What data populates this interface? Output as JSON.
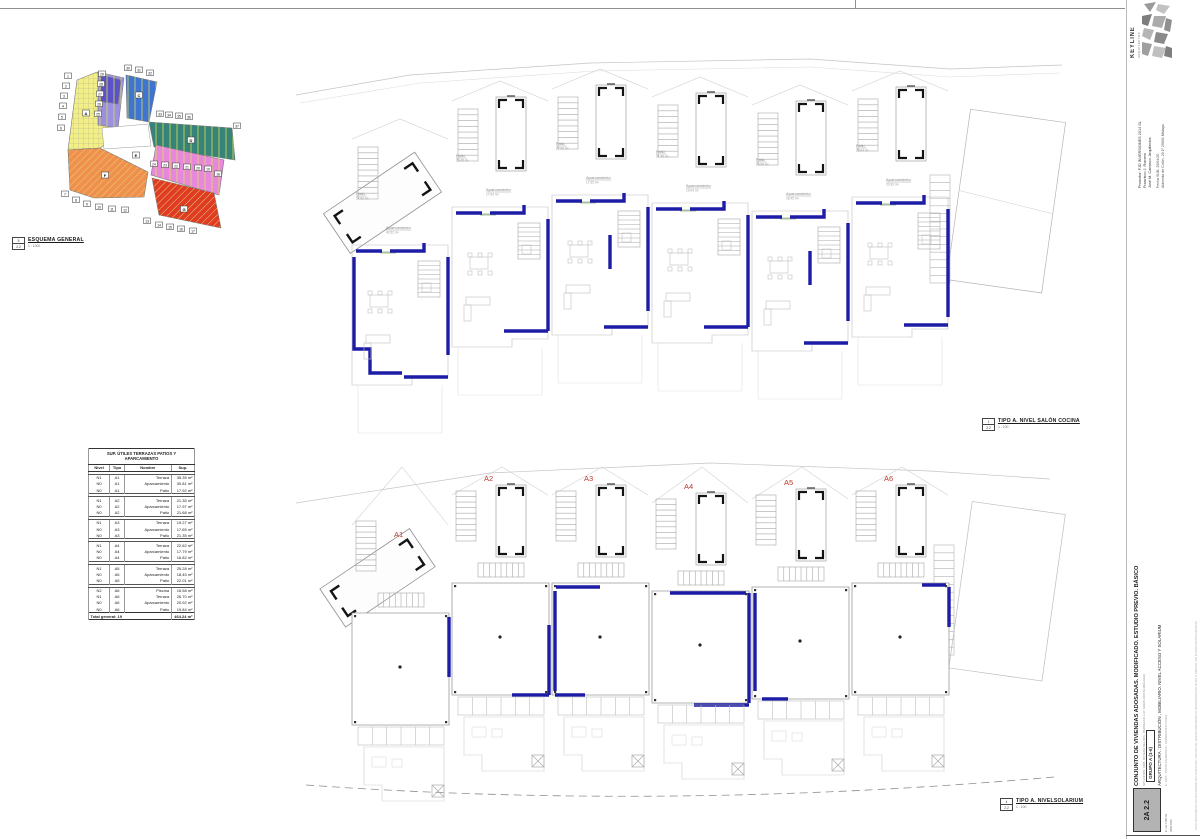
{
  "logo": {
    "brand": "KEYLINE",
    "sub": "ARQUITECTOS"
  },
  "titleblock": {
    "promotor1": "Promotor: FJD INVERSIONES 2014 SL",
    "promotor2": "Francisco J. Romero",
    "promotor3": "José M. Carrasco. Arquitectos",
    "contact1": "Fecha SUB: 29/04/20",
    "contact2": "Alameda de Colón, 29 1º 29001 Málaga"
  },
  "right_title": {
    "main": "CONJUNTO DE VIVIENDAS ADOSADAS. MODIFICADO. ESTUDIO PREVIO. BÁSICO",
    "sub": "SITUACIÓN: URB. RIVIERA DEL SOL. PARCELAS 1-37. MIJAS COSTA (MÁLAGA)",
    "group": "GRUPO A (1-6)",
    "discipline": "ARQUITECTURA : DISTRIBUCIÓN , MOBILIARIO. NIVEL ACCESO Y SOLARIUM",
    "note": "E: 1/100 . COTAS EN METROS . SUPERFICIES ÚTILES",
    "legal": "ESTE DOCUMENTO ES PROPIEDAD DEL AUTOR DEL PROYECTO. QUEDA PROHIBIDA SU REPRODUCCIÓN TOTAL O PARCIAL SIN AUTORIZACIÓN EXPRESA",
    "sheet_no": "2A 2.2",
    "sheet_note1": "E: var / DIN A1",
    "sheet_note2": "ABR 2020"
  },
  "esquema": {
    "label": "ESQUEMA GENERAL",
    "scale": "1 : 1000",
    "ref_top": "5",
    "ref_bottom": "2.2"
  },
  "plan1": {
    "label": "TIPO A. NIVEL SALÓN COCINA",
    "scale": "1 : 100",
    "ref_top": "1",
    "ref_bottom": "2.2"
  },
  "plan2": {
    "label": "TIPO A. NIVELSOLARIUM",
    "scale": "1 : 100",
    "ref_top": "4",
    "ref_bottom": "2.2"
  },
  "colors": {
    "wall_blue": "#1c1ca6",
    "unit_red": "#c0392b",
    "line_gray": "#9a9a9a",
    "line_light": "#c4c4c4",
    "line_faint": "#d9d9d9",
    "bracket_black": "#141414"
  },
  "plan1_units": [
    {
      "id": "A1",
      "patio_label": "Patio",
      "patio_area": "17.92 m²",
      "aparc_label": "Aparcamiento",
      "aparc_area": "40.52 m²"
    },
    {
      "id": "A2",
      "patio_label": "Patio",
      "patio_area": "23.45 m²",
      "aparc_label": "Aparcamiento",
      "aparc_area": "17.54 m²"
    },
    {
      "id": "A3",
      "patio_label": "Patio",
      "patio_area": "27.05 m²",
      "aparc_label": "Aparcamiento",
      "aparc_area": "17.65 m²"
    },
    {
      "id": "A4",
      "patio_label": "Patio",
      "patio_area": "21.35 m²",
      "aparc_label": "Aparcamiento",
      "aparc_area": "19.94 m²"
    },
    {
      "id": "A5",
      "patio_label": "Patio",
      "patio_area": "20.09 m²",
      "aparc_label": "Aparcamiento",
      "aparc_area": "18.45 m²"
    },
    {
      "id": "A6",
      "patio_label": "Patio",
      "patio_area": "23.04 m²",
      "aparc_label": "Aparcamiento",
      "aparc_area": "20.92 m²"
    }
  ],
  "plan2_units": [
    {
      "id": "A1"
    },
    {
      "id": "A2"
    },
    {
      "id": "A3"
    },
    {
      "id": "A4"
    },
    {
      "id": "A5"
    },
    {
      "id": "A6"
    }
  ],
  "table": {
    "title": "SUP. ÚTILES TERRAZAS PATIOS Y APARCAMIENTO",
    "headers": [
      "Nivel",
      "Tipo",
      "Nombre",
      "Sup."
    ],
    "groups": [
      {
        "rows": [
          [
            "N1",
            "A1",
            "Terraza",
            "35.35 m²"
          ],
          [
            "N0",
            "A1",
            "Aparcamiento",
            "30.81 m²"
          ],
          [
            "N0",
            "A1",
            "Patio",
            "17.92 m²"
          ]
        ]
      },
      {
        "rows": [
          [
            "N1",
            "A2",
            "Terraza",
            "21.35 m²"
          ],
          [
            "N0",
            "A2",
            "Aparcamiento",
            "17.97 m²"
          ],
          [
            "N0",
            "A2",
            "Patio",
            "21.68 m²"
          ]
        ]
      },
      {
        "rows": [
          [
            "N1",
            "A3",
            "Terraza",
            "19.27 m²"
          ],
          [
            "N0",
            "A3",
            "Aparcamiento",
            "17.65 m²"
          ],
          [
            "N0",
            "A3",
            "Patio",
            "21.35 m²"
          ]
        ]
      },
      {
        "rows": [
          [
            "N1",
            "A4",
            "Terraza",
            "22.62 m²"
          ],
          [
            "N0",
            "A4",
            "Aparcamiento",
            "17.79 m²"
          ],
          [
            "N0",
            "A4",
            "Patio",
            "16.82 m²"
          ]
        ]
      },
      {
        "rows": [
          [
            "N1",
            "A5",
            "Terraza",
            "25.28 m²"
          ],
          [
            "N0",
            "A5",
            "Aparcamiento",
            "18.45 m²"
          ],
          [
            "N0",
            "A5",
            "Patio",
            "22.01 m²"
          ]
        ]
      },
      {
        "rows": [
          [
            "N2",
            "A6",
            "Piscina",
            "16.58 m²"
          ],
          [
            "N1",
            "A6",
            "Terraza",
            "26.70 m²"
          ],
          [
            "N0",
            "A6",
            "Aparcamiento",
            "20.92 m²"
          ],
          [
            "N0",
            "A6",
            "Patio",
            "19.84 m²"
          ]
        ]
      }
    ],
    "total_label": "Total general: 19",
    "total_value": "464.24 m²"
  },
  "siteplan": {
    "zones": [
      {
        "name": "zona-amarilla",
        "color": "#f2ef86",
        "letter": "A",
        "lx": 78,
        "ly": 86,
        "points": "69,52 89,44 94,52 101,114 92,120 60,122",
        "hatch": "grid"
      },
      {
        "name": "zona-violeta",
        "color": "#9a8fe0",
        "letter": "B",
        "lx": 100,
        "ly": 72,
        "points": "90,44 116,50 110,100 90,97",
        "hatch": "vert"
      },
      {
        "name": "zona-violeta-int",
        "color": "#5b52c7",
        "letter": "",
        "lx": 0,
        "ly": 0,
        "points": "93,47 113,52 110,76 93,73",
        "hatch": "vert"
      },
      {
        "name": "zona-azul",
        "color": "#3f74d2",
        "letter": "C",
        "lx": 131,
        "ly": 68,
        "points": "118,47 149,54 141,94 119,90",
        "hatch": "vert"
      },
      {
        "name": "zona-verde",
        "color": "#37837a",
        "letter": "D",
        "lx": 183,
        "ly": 113,
        "points": "141,94 224,100 227,132 146,119",
        "hatch": "vert"
      },
      {
        "name": "zona-rosa",
        "color": "#e888dd",
        "letter": "E",
        "lx": 128,
        "ly": 128,
        "points": "148,117 216,132 211,167 143,147",
        "hatch": "vert"
      },
      {
        "name": "zona-naranja",
        "color": "#ef9052",
        "letter": "F",
        "lx": 97,
        "ly": 148,
        "points": "60,122 92,120 140,144 136,169 86,170 62,162",
        "hatch": "diag"
      },
      {
        "name": "zona-roja",
        "color": "#e03a28",
        "letter": "G",
        "lx": 176,
        "ly": 182,
        "points": "144,150 206,165 213,200 151,187",
        "hatch": "diag"
      }
    ],
    "court_points": "94,100 140,96 143,118 96,121",
    "numbers": [
      {
        "n": "1",
        "x": 60,
        "y": 48
      },
      {
        "n": "2",
        "x": 58,
        "y": 58
      },
      {
        "n": "3",
        "x": 56,
        "y": 68
      },
      {
        "n": "4",
        "x": 55,
        "y": 78
      },
      {
        "n": "5",
        "x": 54,
        "y": 89
      },
      {
        "n": "6",
        "x": 53,
        "y": 100
      },
      {
        "n": "7",
        "x": 57,
        "y": 166
      },
      {
        "n": "8",
        "x": 68,
        "y": 172
      },
      {
        "n": "9",
        "x": 79,
        "y": 176
      },
      {
        "n": "10",
        "x": 91,
        "y": 179
      },
      {
        "n": "11",
        "x": 104,
        "y": 181
      },
      {
        "n": "12",
        "x": 117,
        "y": 182
      },
      {
        "n": "13",
        "x": 139,
        "y": 193
      },
      {
        "n": "14",
        "x": 151,
        "y": 197
      },
      {
        "n": "15",
        "x": 162,
        "y": 199
      },
      {
        "n": "16",
        "x": 173,
        "y": 201
      },
      {
        "n": "17",
        "x": 185,
        "y": 203
      },
      {
        "n": "18",
        "x": 210,
        "y": 146
      },
      {
        "n": "19",
        "x": 200,
        "y": 141
      },
      {
        "n": "20",
        "x": 190,
        "y": 140
      },
      {
        "n": "21",
        "x": 179,
        "y": 139
      },
      {
        "n": "22",
        "x": 168,
        "y": 138
      },
      {
        "n": "23",
        "x": 157,
        "y": 137
      },
      {
        "n": "24",
        "x": 146,
        "y": 136
      },
      {
        "n": "25",
        "x": 90,
        "y": 86
      },
      {
        "n": "26",
        "x": 91,
        "y": 76
      },
      {
        "n": "27",
        "x": 92,
        "y": 66
      },
      {
        "n": "28",
        "x": 93,
        "y": 56
      },
      {
        "n": "29",
        "x": 94,
        "y": 46
      },
      {
        "n": "30",
        "x": 120,
        "y": 40
      },
      {
        "n": "31",
        "x": 131,
        "y": 42
      },
      {
        "n": "32",
        "x": 142,
        "y": 45
      },
      {
        "n": "33",
        "x": 152,
        "y": 86
      },
      {
        "n": "34",
        "x": 161,
        "y": 87
      },
      {
        "n": "35",
        "x": 171,
        "y": 88
      },
      {
        "n": "36",
        "x": 181,
        "y": 89
      },
      {
        "n": "37",
        "x": 229,
        "y": 98
      }
    ]
  }
}
